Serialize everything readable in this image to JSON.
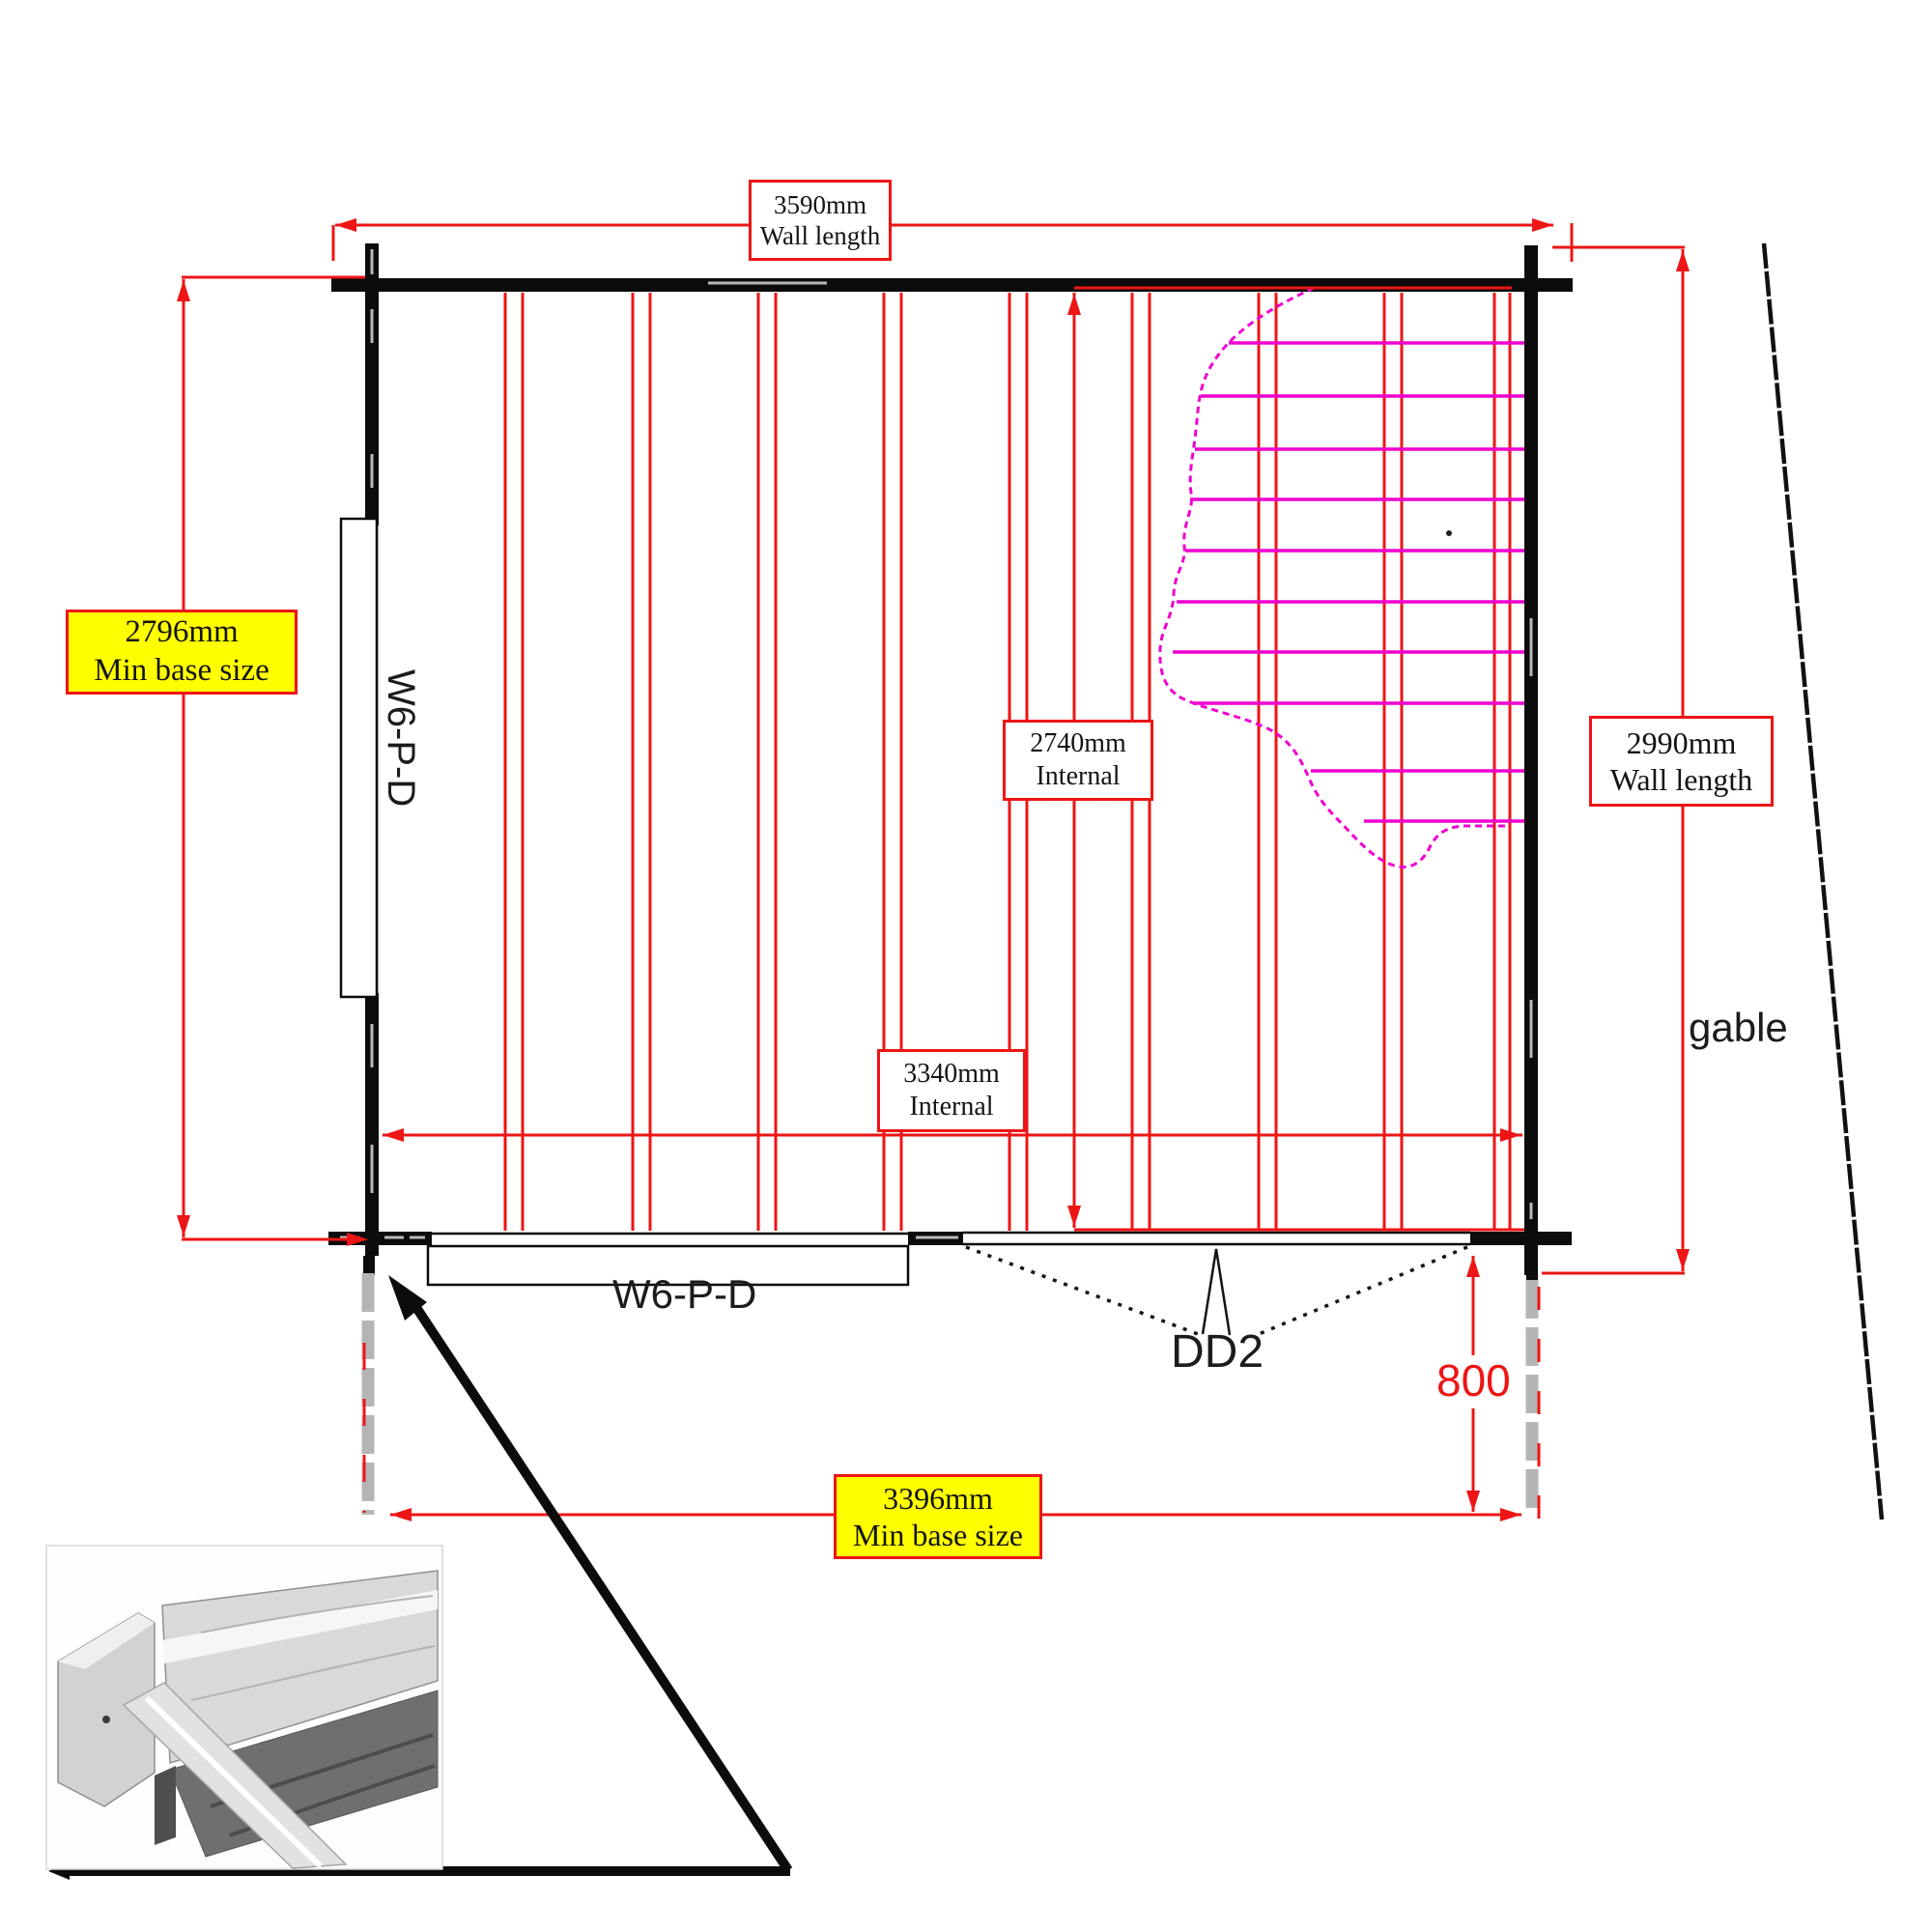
{
  "diagram": {
    "type": "floor-plan technical drawing",
    "subject": "log cabin base plan with wall, base and internal dimensions"
  },
  "dimensions": {
    "top": {
      "value": "3590mm",
      "caption": "Wall length"
    },
    "left": {
      "value": "2796mm",
      "caption": "Min base size"
    },
    "right": {
      "value": "2990mm",
      "caption": "Wall length"
    },
    "internal_vertical": {
      "value": "2740mm",
      "caption": "Internal"
    },
    "internal_horizontal": {
      "value": "3340mm",
      "caption": "Internal"
    },
    "bottom": {
      "value": "3396mm",
      "caption": "Min base size"
    },
    "door_offset": "800"
  },
  "annotations": {
    "door_code": "DD2",
    "left_window_code": "W6-P-D",
    "front_window_code": "W6-P-D",
    "gable_label": "gable"
  },
  "colors": {
    "dimension_red": "#ed1515",
    "hatch_magenta": "#ef00d0",
    "highlight_yellow": "#ffff00",
    "wall_black": "#0c0c0c",
    "post_grey": "#b5b5b5"
  }
}
